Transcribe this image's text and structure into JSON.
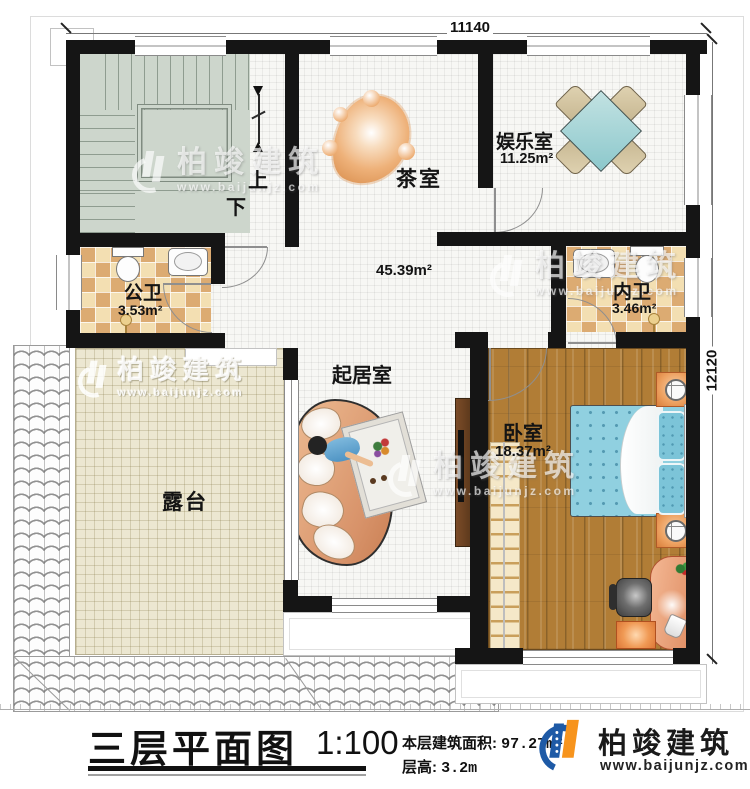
{
  "plan": {
    "dim_top": "11140",
    "dim_right": "12120",
    "stairs": {
      "up": "上",
      "down": "下"
    },
    "rooms": {
      "tea": {
        "name": "茶室"
      },
      "fun": {
        "name": "娱乐室",
        "area": "11.25m²"
      },
      "pubwc": {
        "name": "公卫",
        "area": "3.53m²"
      },
      "hall": {
        "area": "45.39m²"
      },
      "inwc": {
        "name": "内卫",
        "area": "3.46m²"
      },
      "terrace": {
        "name": "露台"
      },
      "living": {
        "name": "起居室"
      },
      "bed": {
        "name": "卧室",
        "area": "18.37m²"
      }
    }
  },
  "titleblock": {
    "title": "三层平面图",
    "scale": "1:100",
    "area_label": "本层建筑面积:",
    "area_value": "97.27m²",
    "height_label": "层高:",
    "height_value": "3.2m"
  },
  "brand": {
    "name": "柏竣建筑",
    "url": "www.baijunjz.com"
  },
  "watermark": {
    "name": "柏竣建筑",
    "url": "www.baijunjz.com"
  },
  "colors": {
    "wall": "#151515",
    "checker_light": "#f3dfb2",
    "checker_dark": "#dcab72",
    "wood": "#b17d36",
    "bed_blue": "#90d0e0",
    "terrace": "#ece7d1",
    "stair": "#cdd6cc",
    "brand_blue": "#1e5aa6",
    "brand_orange": "#f7941d"
  }
}
